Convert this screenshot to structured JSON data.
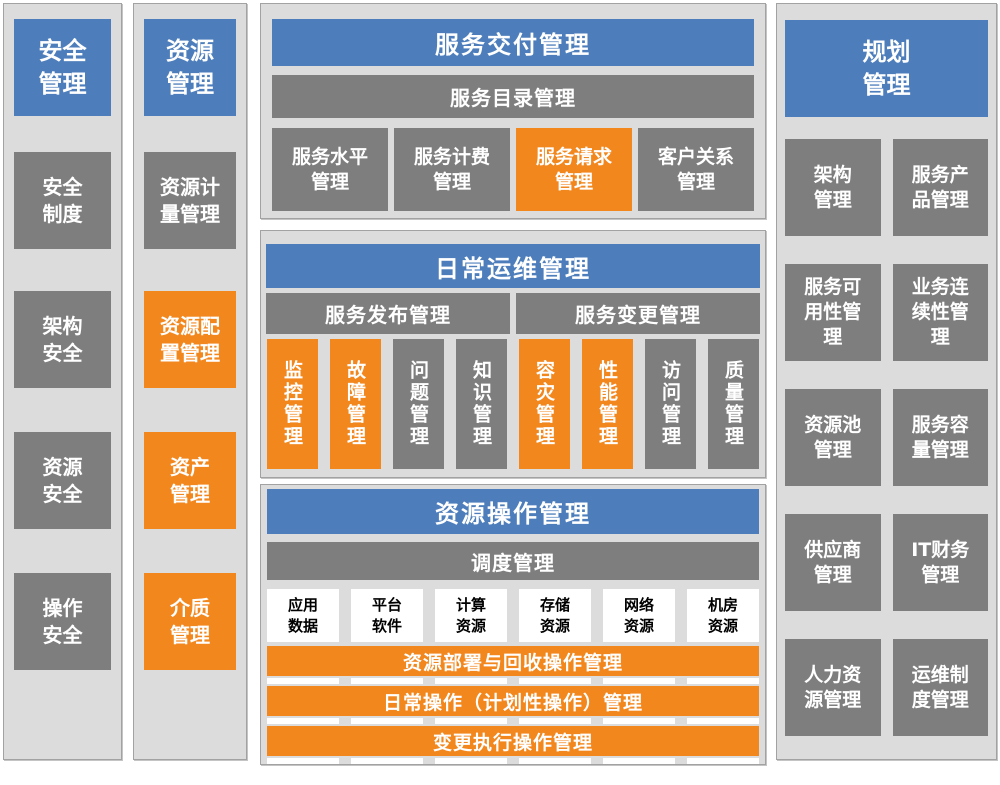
{
  "colors": {
    "header_blue": "#4D7EBB",
    "process_gray": "#7E7E7E",
    "highlight_orange": "#F2871E",
    "panel_background": "#DCDCDC",
    "panel_border": "#A2A2A2",
    "box_text": "#FFFFFF",
    "resource_box_background": "#FFFFFF",
    "resource_box_text": "#000000"
  },
  "security_panel": {
    "title": "安全\n管理",
    "items": [
      {
        "label": "安全\n制度",
        "variant": "gray"
      },
      {
        "label": "架构\n安全",
        "variant": "gray"
      },
      {
        "label": "资源\n安全",
        "variant": "gray"
      },
      {
        "label": "操作\n安全",
        "variant": "gray"
      }
    ]
  },
  "resource_panel": {
    "title": "资源\n管理",
    "items": [
      {
        "label": "资源计\n量管理",
        "variant": "gray"
      },
      {
        "label": "资源配\n置管理",
        "variant": "orange"
      },
      {
        "label": "资产\n管理",
        "variant": "orange"
      },
      {
        "label": "介质\n管理",
        "variant": "orange"
      }
    ]
  },
  "service_delivery": {
    "title": "服务交付管理",
    "subtitle": "服务目录管理",
    "items": [
      {
        "label": "服务水平\n管理",
        "variant": "gray"
      },
      {
        "label": "服务计费\n管理",
        "variant": "gray"
      },
      {
        "label": "服务请求\n管理",
        "variant": "orange"
      },
      {
        "label": "客户关系\n管理",
        "variant": "gray"
      }
    ]
  },
  "daily_ops": {
    "title": "日常运维管理",
    "sub_bars": [
      "服务发布管理",
      "服务变更管理"
    ],
    "items": [
      {
        "label": "监控管理",
        "variant": "orange"
      },
      {
        "label": "故障管理",
        "variant": "orange"
      },
      {
        "label": "问题管理",
        "variant": "gray"
      },
      {
        "label": "知识管理",
        "variant": "gray"
      },
      {
        "label": "容灾管理",
        "variant": "orange"
      },
      {
        "label": "性能管理",
        "variant": "orange"
      },
      {
        "label": "访问管理",
        "variant": "gray"
      },
      {
        "label": "质量管理",
        "variant": "gray"
      }
    ]
  },
  "resource_ops": {
    "title": "资源操作管理",
    "subtitle": "调度管理",
    "resource_boxes": [
      {
        "label": "应用\n数据"
      },
      {
        "label": "平台\n软件"
      },
      {
        "label": "计算\n资源"
      },
      {
        "label": "存储\n资源"
      },
      {
        "label": "网络\n资源"
      },
      {
        "label": "机房\n资源"
      }
    ],
    "op_bars": [
      {
        "label": "资源部署与回收操作管理"
      },
      {
        "label": "日常操作（计划性操作）管理"
      },
      {
        "label": "变更执行操作管理"
      }
    ]
  },
  "planning_panel": {
    "title": "规划\n管理",
    "items": [
      {
        "label": "架构\n管理"
      },
      {
        "label": "服务产\n品管理"
      },
      {
        "label": "服务可\n用性管\n理"
      },
      {
        "label": "业务连\n续性管\n理"
      },
      {
        "label": "资源池\n管理"
      },
      {
        "label": "服务容\n量管理"
      },
      {
        "label": "供应商\n管理"
      },
      {
        "label": "IT财务\n管理"
      },
      {
        "label": "人力资\n源管理"
      },
      {
        "label": "运维制\n度管理"
      }
    ]
  }
}
